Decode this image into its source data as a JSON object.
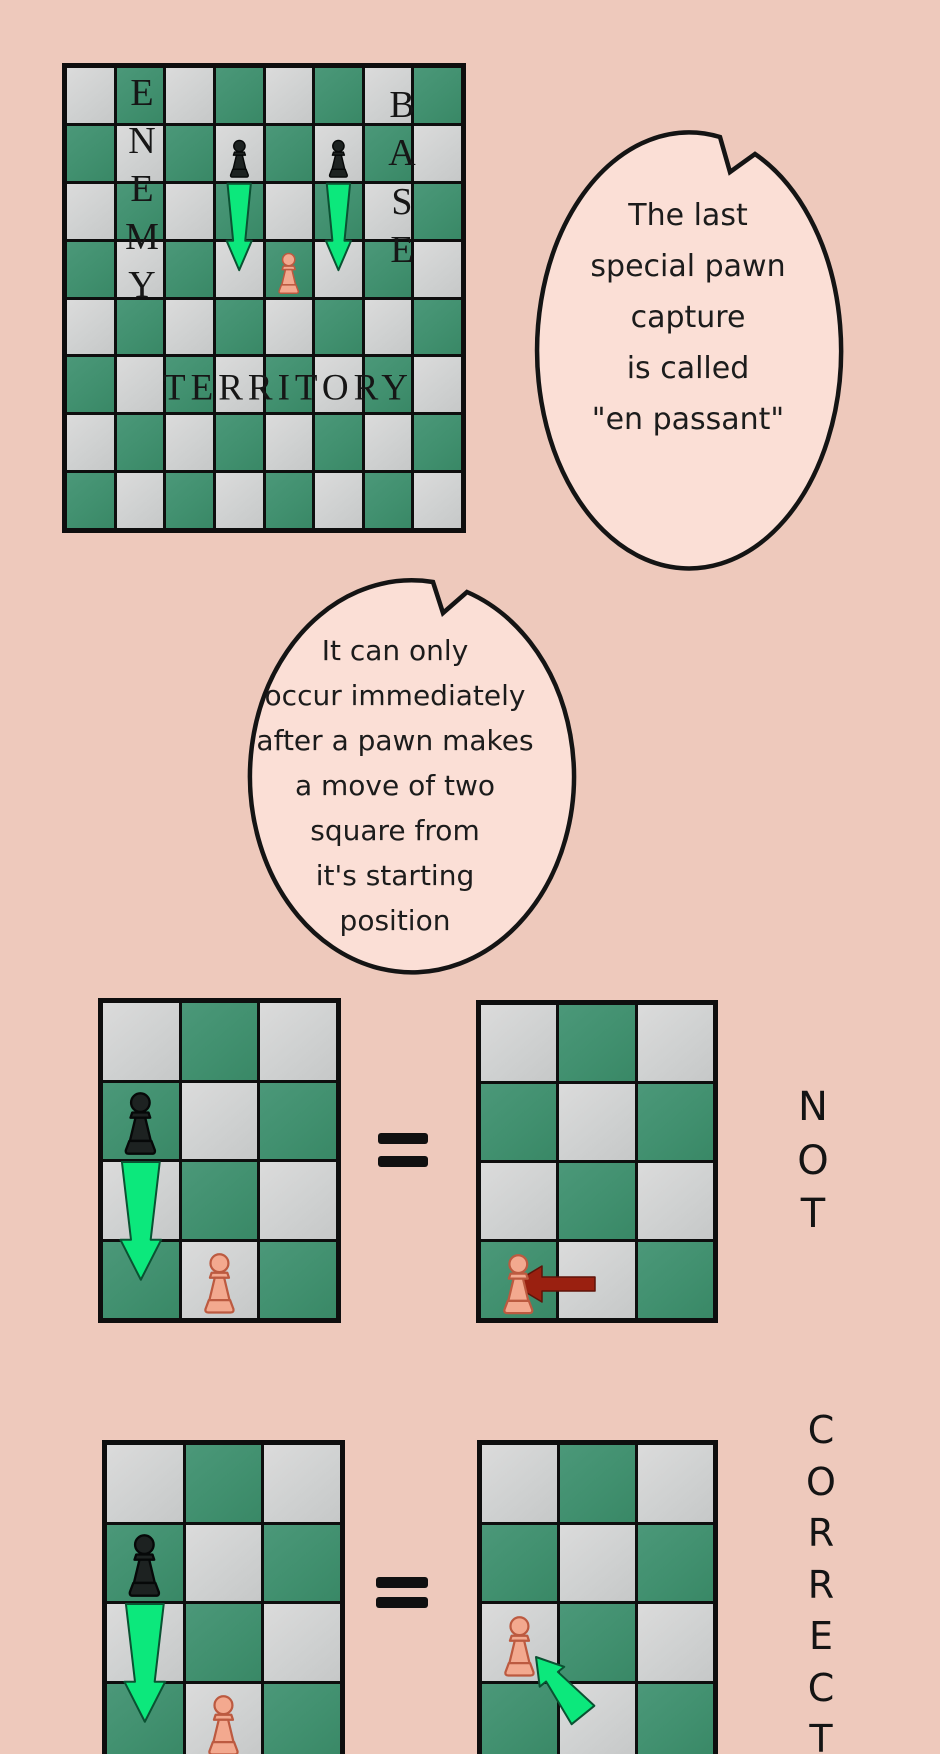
{
  "page": {
    "width": 940,
    "height": 1754,
    "background": "#eec9bc"
  },
  "palette": {
    "square_green": "#41906f",
    "square_light": "#d2d2d2",
    "board_line": "#0e0e0e",
    "bubble_fill": "#fbdfd6",
    "bubble_stroke": "#141414",
    "arrow_green": "#0ce87c",
    "arrow_green_stroke": "#0a5232",
    "arrow_red": "#9a2010",
    "pawn_black_fill": "#1d2221",
    "pawn_black_stroke": "#060808",
    "pawn_pink_fill": "#f3a98f",
    "pawn_pink_stroke": "#bc5a40",
    "text_dark": "#1a1a1a"
  },
  "bubbles": [
    {
      "name": "speech-bubble-1",
      "lines": [
        "The last",
        "special pawn",
        "capture",
        "is called",
        "\"en passant\""
      ]
    },
    {
      "name": "speech-bubble-2",
      "lines": [
        "It can only",
        "occur immediately",
        "after a pawn makes",
        "a move of two",
        "square from",
        "it's starting",
        "position"
      ]
    }
  ],
  "side_labels": [
    {
      "name": "label-not",
      "text": "NOT",
      "x": 813,
      "y_start": 1107,
      "spacing": 53.5,
      "font_size": 40
    },
    {
      "name": "label-correct",
      "text": "CORRECT",
      "x": 821,
      "y_start": 1430,
      "spacing": 51.5,
      "font_size": 38
    }
  ],
  "equals_signs": [
    {
      "symbol": "=",
      "x": 378,
      "y": 1133,
      "bar_w": 50,
      "bar_h": 11,
      "gap": 12
    },
    {
      "symbol": "=",
      "x": 376,
      "y": 1577,
      "bar_w": 52,
      "bar_h": 11,
      "gap": 9
    }
  ],
  "boards": [
    {
      "name": "board-main-territory",
      "x": 62,
      "y": 63,
      "w": 404,
      "h": 470,
      "cols": 8,
      "rows": 8,
      "words": [
        {
          "name": "label-enemy",
          "text": "ENEMY",
          "orient": "vertical",
          "x": 75,
          "y_start": 25,
          "spacing": 48,
          "font_size": 38
        },
        {
          "name": "label-base",
          "text": "BASE",
          "orient": "vertical",
          "x": 335,
          "y_start": 37,
          "spacing": 48.3,
          "font_size": 38
        },
        {
          "name": "label-territory",
          "text": "TERRITORY",
          "orient": "horizontal",
          "x": 221,
          "y_start": 320,
          "spacing": 0,
          "font_size": 37
        }
      ],
      "pieces": [
        {
          "type": "pawn",
          "color": "black",
          "col": 4,
          "row": 2,
          "scale": 0.72
        },
        {
          "type": "pawn",
          "color": "black",
          "col": 6,
          "row": 2,
          "scale": 0.72
        },
        {
          "type": "pawn",
          "color": "pink",
          "col": 5,
          "row": 4,
          "scale": 0.78
        }
      ],
      "arrows": [
        {
          "kind": "down",
          "name": "green-down-arrow",
          "col": 4,
          "from_row": 3,
          "tip_row": 4,
          "tip_frac": 0.52,
          "w": 1
        },
        {
          "kind": "down",
          "name": "green-down-arrow",
          "col": 6,
          "from_row": 3,
          "tip_row": 4,
          "tip_frac": 0.52,
          "w": 1
        }
      ]
    },
    {
      "name": "board-not-left",
      "x": 98,
      "y": 998,
      "w": 243,
      "h": 325,
      "cols": 3,
      "rows": 4,
      "words": [],
      "pieces": [
        {
          "type": "pawn",
          "color": "black",
          "col": 1,
          "row": 2,
          "scale": 0.85
        },
        {
          "type": "pawn",
          "color": "pink",
          "col": 2,
          "row": 4,
          "scale": 0.82
        }
      ],
      "arrows": [
        {
          "kind": "down",
          "name": "green-down-arrow",
          "col": 1,
          "from_row": 3,
          "tip_row": 4,
          "tip_frac": 0.5,
          "w": 1
        }
      ]
    },
    {
      "name": "board-not-right",
      "x": 476,
      "y": 1000,
      "w": 242,
      "h": 323,
      "cols": 3,
      "rows": 4,
      "words": [],
      "pieces": [
        {
          "type": "pawn",
          "color": "pink",
          "col": 1,
          "row": 4,
          "scale": 0.82
        }
      ],
      "arrows": [
        {
          "kind": "left",
          "name": "red-left-arrow",
          "tip": [
            31,
            279
          ],
          "len": 83
        }
      ]
    },
    {
      "name": "board-correct-left",
      "x": 102,
      "y": 1440,
      "w": 243,
      "h": 325,
      "cols": 3,
      "rows": 4,
      "words": [],
      "pieces": [
        {
          "type": "pawn",
          "color": "black",
          "col": 1,
          "row": 2,
          "scale": 0.85
        },
        {
          "type": "pawn",
          "color": "pink",
          "col": 2,
          "row": 4,
          "scale": 0.82
        }
      ],
      "arrows": [
        {
          "kind": "down",
          "name": "green-down-arrow",
          "col": 1,
          "from_row": 3,
          "tip_row": 4,
          "tip_frac": 0.5,
          "w": 1
        }
      ]
    },
    {
      "name": "board-correct-right",
      "x": 477,
      "y": 1440,
      "w": 241,
      "h": 325,
      "cols": 3,
      "rows": 4,
      "words": [],
      "pieces": [
        {
          "type": "pawn",
          "color": "pink",
          "col": 1,
          "row": 3,
          "scale": 0.82
        }
      ],
      "arrows": [
        {
          "kind": "diag",
          "name": "green-diagonal-arrow",
          "tail": [
            101,
            270
          ],
          "tip": [
            54,
            212
          ],
          "w": 0.78
        }
      ]
    }
  ]
}
